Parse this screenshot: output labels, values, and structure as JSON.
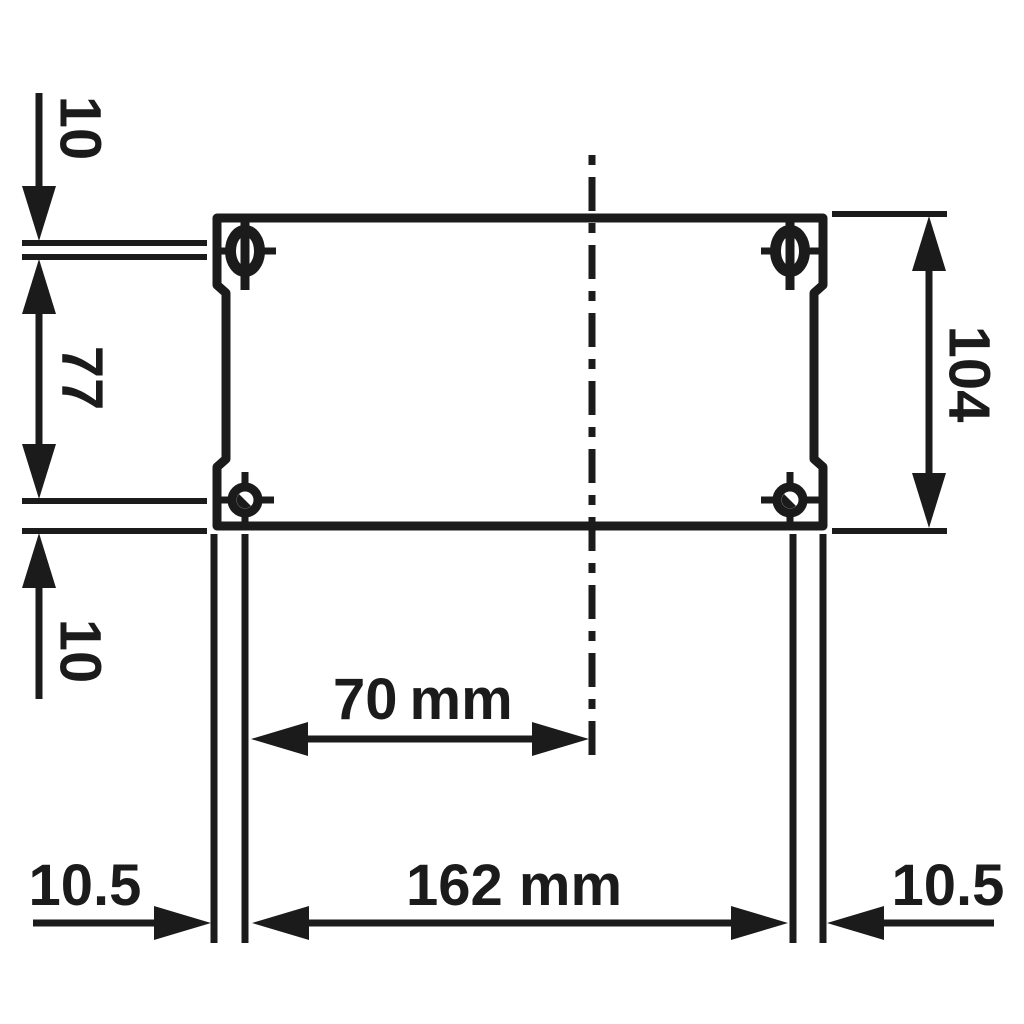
{
  "colors": {
    "ink": "#1b1b1b",
    "background": "#ffffff"
  },
  "labels": {
    "top_hole_offset": "10",
    "left_hole_spacing": "77",
    "bottom_hole_offset": "10",
    "overall_height": "104",
    "hole_to_center_value": "70",
    "hole_to_center_unit": "mm",
    "leg_spacing": "162 mm",
    "left_leg_width": "10.5",
    "right_leg_width": "10.5"
  }
}
